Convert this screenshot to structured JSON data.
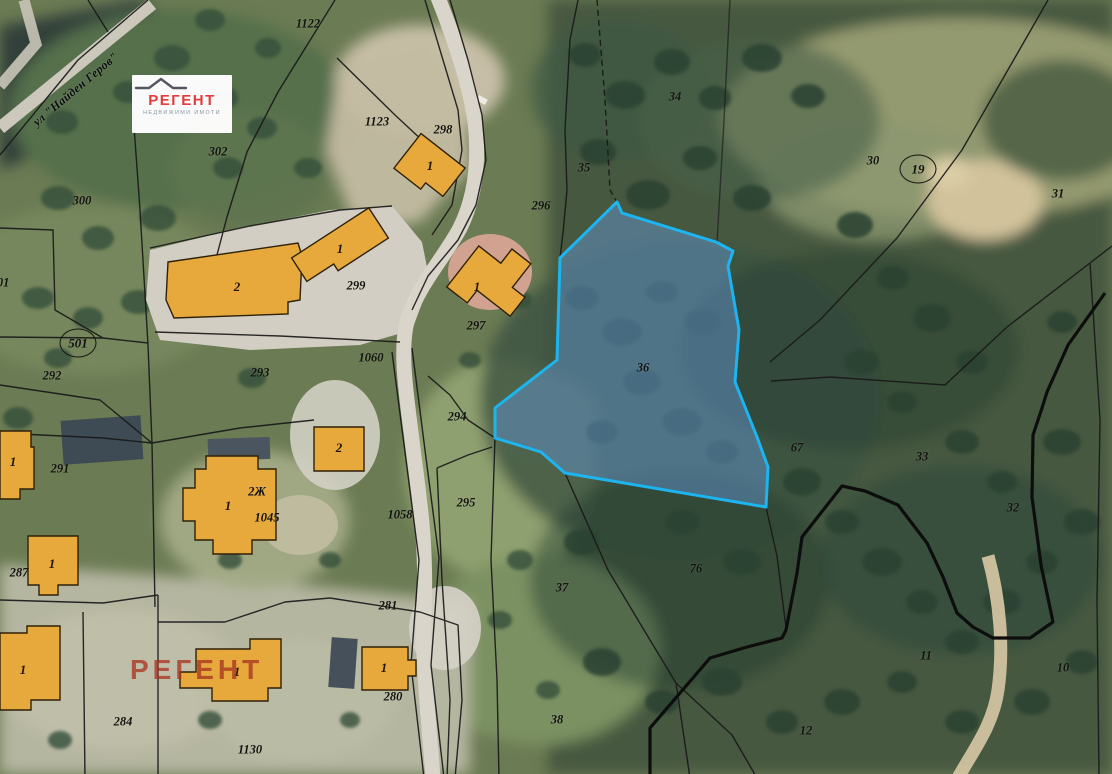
{
  "map": {
    "street_label": "ул \"Найден Геров\"",
    "highlighted_parcel": {
      "label": "36",
      "outline_color": "#1db4f0",
      "fill_color": "rgba(98,148,205,0.5)"
    },
    "parcel_labels": [
      {
        "text": "1122",
        "x": 308,
        "y": 24
      },
      {
        "text": "302",
        "x": 218,
        "y": 152
      },
      {
        "text": "300",
        "x": 82,
        "y": 201
      },
      {
        "text": "301",
        "x": 0,
        "y": 283
      },
      {
        "text": "1123",
        "x": 377,
        "y": 122
      },
      {
        "text": "298",
        "x": 443,
        "y": 130
      },
      {
        "text": "296",
        "x": 541,
        "y": 206
      },
      {
        "text": "299",
        "x": 356,
        "y": 286
      },
      {
        "text": "297",
        "x": 476,
        "y": 326
      },
      {
        "text": "1060",
        "x": 371,
        "y": 358
      },
      {
        "text": "292",
        "x": 52,
        "y": 376
      },
      {
        "text": "293",
        "x": 260,
        "y": 373
      },
      {
        "text": "294",
        "x": 457,
        "y": 417
      },
      {
        "text": "295",
        "x": 466,
        "y": 503
      },
      {
        "text": "1058",
        "x": 400,
        "y": 515
      },
      {
        "text": "291",
        "x": 60,
        "y": 469
      },
      {
        "text": "287",
        "x": 19,
        "y": 573
      },
      {
        "text": "1045",
        "x": 267,
        "y": 518
      },
      {
        "text": "2Ж",
        "x": 257,
        "y": 492
      },
      {
        "text": "281",
        "x": 388,
        "y": 606
      },
      {
        "text": "280",
        "x": 393,
        "y": 697
      },
      {
        "text": "284",
        "x": 123,
        "y": 722
      },
      {
        "text": "1130",
        "x": 250,
        "y": 750
      },
      {
        "text": "35",
        "x": 584,
        "y": 168
      },
      {
        "text": "34",
        "x": 675,
        "y": 97
      },
      {
        "text": "30",
        "x": 873,
        "y": 161
      },
      {
        "text": "31",
        "x": 1058,
        "y": 194
      },
      {
        "text": "36",
        "x": 643,
        "y": 368
      },
      {
        "text": "67",
        "x": 797,
        "y": 448
      },
      {
        "text": "33",
        "x": 922,
        "y": 457
      },
      {
        "text": "32",
        "x": 1013,
        "y": 508
      },
      {
        "text": "76",
        "x": 696,
        "y": 569
      },
      {
        "text": "37",
        "x": 562,
        "y": 588
      },
      {
        "text": "38",
        "x": 557,
        "y": 720
      },
      {
        "text": "11",
        "x": 926,
        "y": 656
      },
      {
        "text": "10",
        "x": 1063,
        "y": 668
      },
      {
        "text": "12",
        "x": 806,
        "y": 731
      }
    ],
    "circled_labels": [
      {
        "text": "501",
        "x": 78,
        "y": 343
      },
      {
        "text": "19",
        "x": 918,
        "y": 169
      }
    ],
    "building_labels": [
      {
        "text": "1",
        "x": 430,
        "y": 166
      },
      {
        "text": "1",
        "x": 477,
        "y": 287
      },
      {
        "text": "2",
        "x": 237,
        "y": 287
      },
      {
        "text": "1",
        "x": 340,
        "y": 249
      },
      {
        "text": "2",
        "x": 339,
        "y": 448
      },
      {
        "text": "1",
        "x": 228,
        "y": 506
      },
      {
        "text": "1",
        "x": 52,
        "y": 564
      },
      {
        "text": "1",
        "x": 13,
        "y": 462
      },
      {
        "text": "1",
        "x": 23,
        "y": 670
      },
      {
        "text": "1",
        "x": 237,
        "y": 672
      },
      {
        "text": "1",
        "x": 384,
        "y": 668
      }
    ]
  },
  "logo": {
    "brand": "РЕГЕНТ",
    "tagline": "НЕДВИЖИМИ ИМОТИ",
    "brand_color": "#e23c3c",
    "tagline_color": "#8b98a3"
  },
  "watermark": {
    "text": "РЕГЕНТ",
    "color": "rgba(168,52,34,0.78)"
  }
}
